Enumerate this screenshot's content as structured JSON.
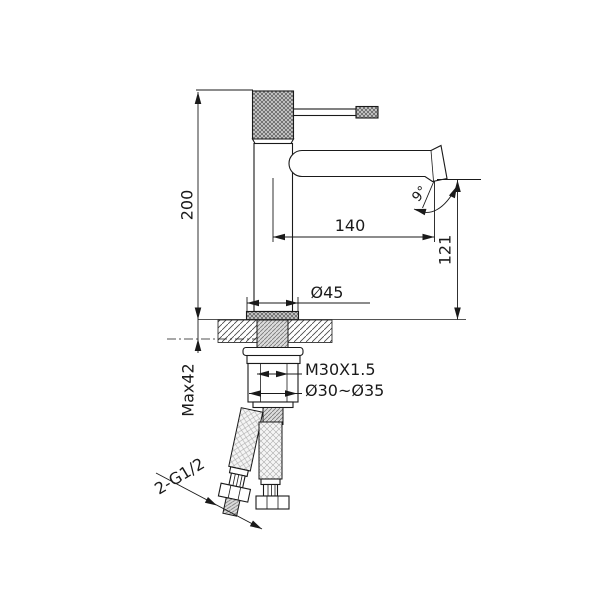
{
  "drawing": {
    "type": "faucet-technical-drawing",
    "background_color": "#ffffff",
    "line_color": "#1a1a1a",
    "dimensions": {
      "overall_height": "200",
      "spout_reach": "140",
      "spout_outlet_height": "121",
      "spout_angle": "9°",
      "base_diameter": "Ø45",
      "mounting_thread": "M30X1.5",
      "hole_diameter_range": "Ø30~Ø35",
      "max_deck_thickness": "Max42",
      "inlet_connections": "2-G1/2"
    }
  }
}
